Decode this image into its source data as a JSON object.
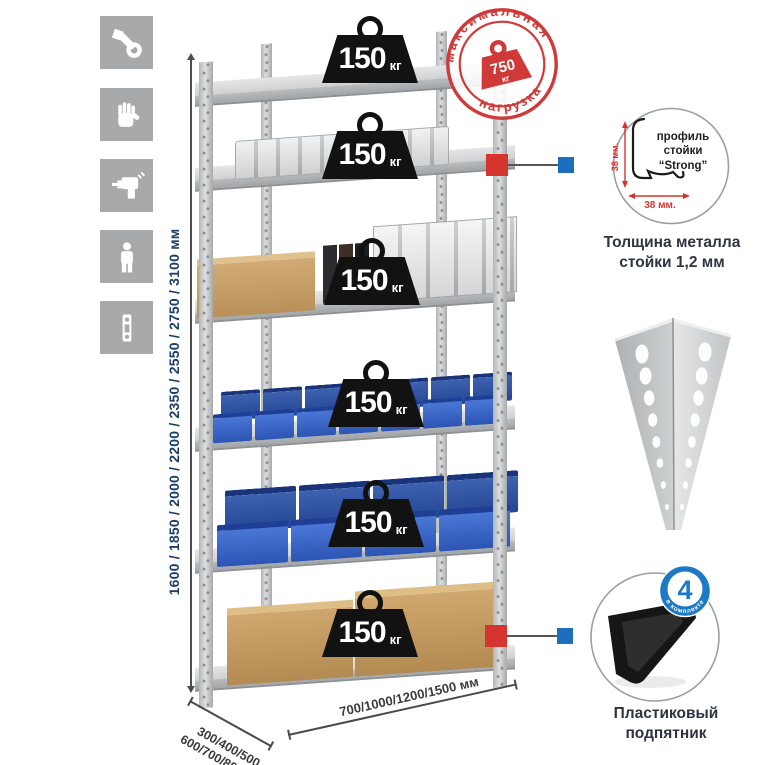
{
  "sidebar": {
    "icons": [
      "wrench-icon",
      "gloves-icon",
      "drill-icon",
      "person-icon",
      "perforated-post-icon"
    ]
  },
  "dimensions": {
    "height_label": "1600 / 1850 / 2000 / 2200 / 2350 / 2550 / 2750 / 3100 мм",
    "depth_label_line1": "300/400/500",
    "depth_label_line2": "600/700/800 мм",
    "width_label": "700/1000/1200/1500 мм"
  },
  "shelves": [
    {
      "load": "150",
      "unit": "кг"
    },
    {
      "load": "150",
      "unit": "кг"
    },
    {
      "load": "150",
      "unit": "кг"
    },
    {
      "load": "150",
      "unit": "кг"
    },
    {
      "load": "150",
      "unit": "кг"
    },
    {
      "load": "150",
      "unit": "кг"
    }
  ],
  "max_load_stamp": {
    "arc_top": "максимальная",
    "arc_bottom": "нагрузка",
    "value": "750",
    "unit": "кг"
  },
  "profile_detail": {
    "label_line1": "профиль",
    "label_line2": "стойки",
    "label_line3": "“Strong”",
    "vertical_dim": "38 мм.",
    "horizontal_dim": "38 мм.",
    "caption_line1": "Толщина металла",
    "caption_line2": "стойки 1,2 мм"
  },
  "foot_detail": {
    "badge_value": "4",
    "badge_caption": "в комплекте",
    "caption_line1": "Пластиковый",
    "caption_line2": "подпятник"
  },
  "colors": {
    "stamp_red": "#cf3a38",
    "marker_red": "#d6342f",
    "marker_blue": "#1d6fbe",
    "badge_blue": "#1d78c6",
    "bin_blue": "#2f5fc4",
    "height_text_navy": "#1c3f68",
    "caption_dark": "#2d3340",
    "icon_gray": "#a7a9ab"
  }
}
